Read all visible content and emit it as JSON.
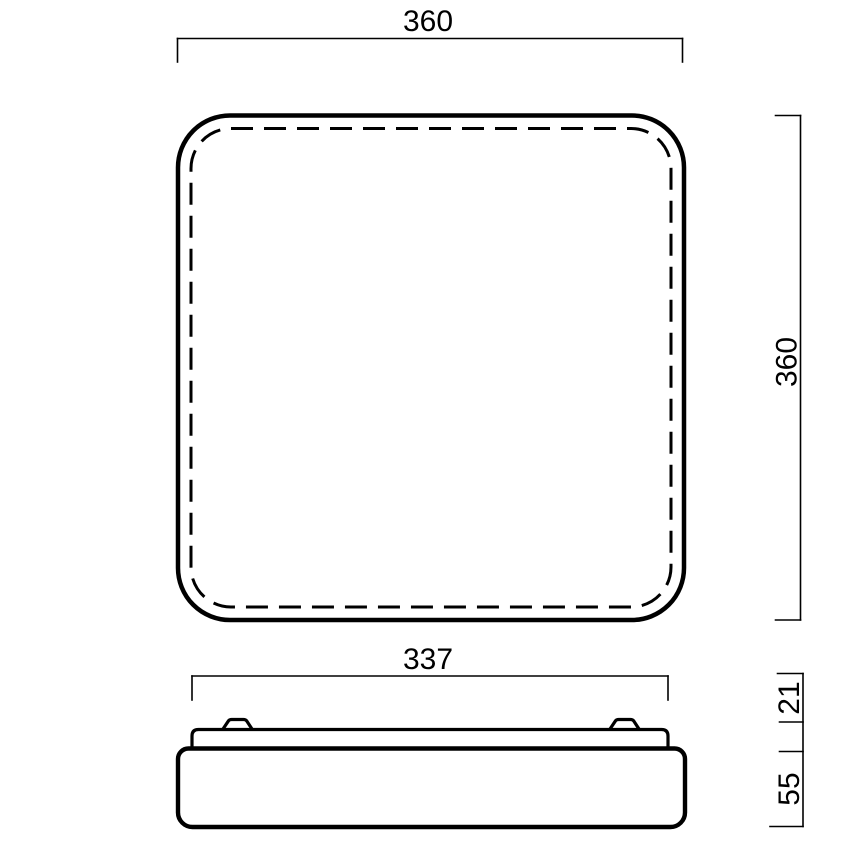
{
  "colors": {
    "line": "#000000",
    "background": "#ffffff"
  },
  "top_view": {
    "description": "top view of square fixture with dashed inner diffuser edge",
    "width_dimension": "360",
    "height_dimension": "360"
  },
  "side_view": {
    "description": "side profile with mounting base plate, two clips and diffuser body",
    "width_dimension": "337",
    "top_section_height_dimension": "21",
    "body_height_dimension": "55"
  }
}
